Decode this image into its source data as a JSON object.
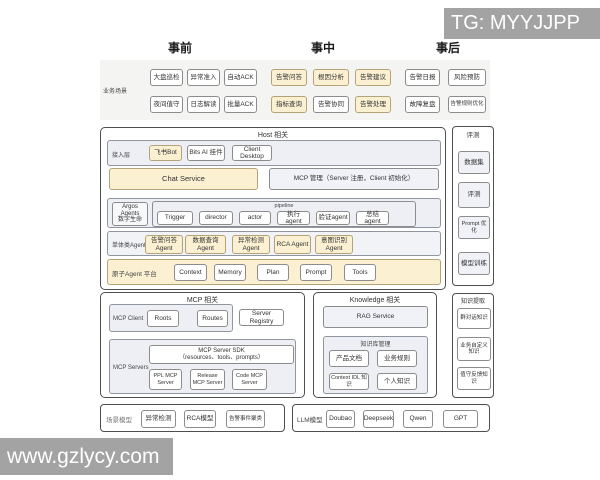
{
  "watermark": {
    "top": "TG: MYYJJPP",
    "bottom": "www.gzlycy.com"
  },
  "phases": {
    "pre": "事前",
    "during": "事中",
    "post": "事后"
  },
  "scenarios": {
    "label": "业务场景",
    "pre_row1": [
      "大盘巡检",
      "异常准入",
      "自动ACK"
    ],
    "pre_row2": [
      "夜间值守",
      "日志解读",
      "批量ACK"
    ],
    "during_row1": [
      "告警问答",
      "根因分析",
      "告警建议"
    ],
    "during_row2": [
      "指标查询",
      "告警协同",
      "告警处理"
    ],
    "post_row1": [
      "告警日报",
      "风险预防"
    ],
    "post_row2": [
      "故障复盘",
      "告警规则优化"
    ]
  },
  "host": {
    "title": "Host 相关",
    "access_label": "接入层",
    "access_items": [
      "飞书Bot",
      "Bits AI 挂件",
      "Client Desktop"
    ],
    "chat_service": "Chat Service",
    "mcp_manage": "MCP 管理（Server 注册，Client 初始化）",
    "argos_label1": "Argos Agents",
    "argos_label2": "数字生命",
    "pipeline_label": "pipeline",
    "pipeline_items": [
      "Trigger",
      "director",
      "actor",
      "执行agent",
      "验证agent",
      "总结agent"
    ],
    "single_label": "单体类Agents",
    "single_items": [
      "告警问答Agent",
      "数据查询Agent",
      "异常检测Agent",
      "RCA Agent",
      "意图识别Agent"
    ],
    "atomic_label": "原子Agent 平台",
    "atomic_items": [
      "Context",
      "Memory",
      "Plan",
      "Prompt",
      "Tools"
    ]
  },
  "mcp": {
    "title": "MCP 相关",
    "client_label": "MCP Client",
    "client_items": [
      "Roots",
      "Routes"
    ],
    "server_registry": "Server Registry",
    "servers_label": "MCP Servers",
    "sdk_line1": "MCP Server SDK",
    "sdk_line2": "（resources、tools、prompts）",
    "server_items": [
      "PPL MCP Server",
      "Release MCP Server",
      "Code MCP Server"
    ]
  },
  "knowledge": {
    "title": "Knowledge 相关",
    "rag": "RAG Service",
    "kb_label": "知识库管理",
    "kb_items": [
      "产品文档",
      "业务规则",
      "Context IDL 知识",
      "个人知识"
    ]
  },
  "evaluation": {
    "title": "评测",
    "items": [
      "数据集",
      "评测",
      "Prompt 优化",
      "模型训练"
    ]
  },
  "extraction": {
    "title": "知识提取",
    "items": [
      "群对话知识",
      "业务自定义知识",
      "值守反馈知识"
    ]
  },
  "scene_models": {
    "label": "场景模型",
    "items": [
      "异常检测",
      "RCA模型",
      "告警事件聚类"
    ]
  },
  "llm_models": {
    "label": "LLM模型",
    "items": [
      "Doubao",
      "Deepseek",
      "Qwen",
      "GPT"
    ]
  }
}
